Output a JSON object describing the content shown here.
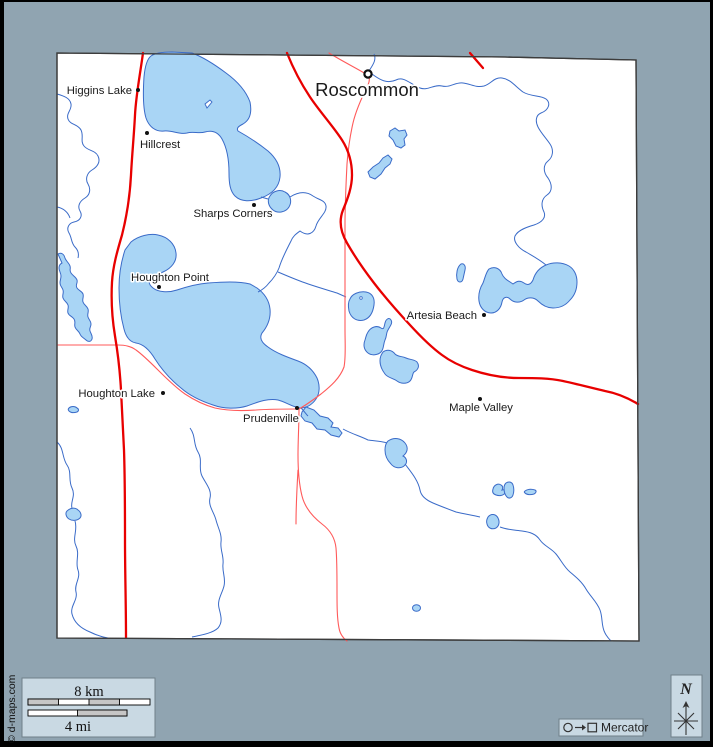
{
  "towns": {
    "roscommon": {
      "name": "Roscommon"
    },
    "higgins_lake": {
      "name": "Higgins Lake"
    },
    "hillcrest": {
      "name": "Hillcrest"
    },
    "sharps_corners": {
      "name": "Sharps Corners"
    },
    "houghton_point": {
      "name": "Houghton Point"
    },
    "houghton_lake": {
      "name": "Houghton Lake"
    },
    "prudenville": {
      "name": "Prudenville"
    },
    "artesia_beach": {
      "name": "Artesia Beach"
    },
    "maple_valley": {
      "name": "Maple Valley"
    }
  },
  "scale_bar": {
    "km_label": "8 km",
    "mi_label": "4 mi"
  },
  "legend": {
    "projection": "Mercator"
  },
  "compass": {
    "north_label": "N"
  },
  "credit": {
    "copyright": "© d-maps.com"
  },
  "colors": {
    "frame": "#000000",
    "background": "#90A4B1",
    "county_fill": "#FFFFFF",
    "county_border": "#3C3C3C",
    "lake_fill": "#A9D5F5",
    "water_stroke": "#3A6BC8",
    "road_primary": "#E80000",
    "road_secondary": "#FF5A5A",
    "panel_fill": "#C9D9E3",
    "label_color": "#1A1A1A"
  }
}
